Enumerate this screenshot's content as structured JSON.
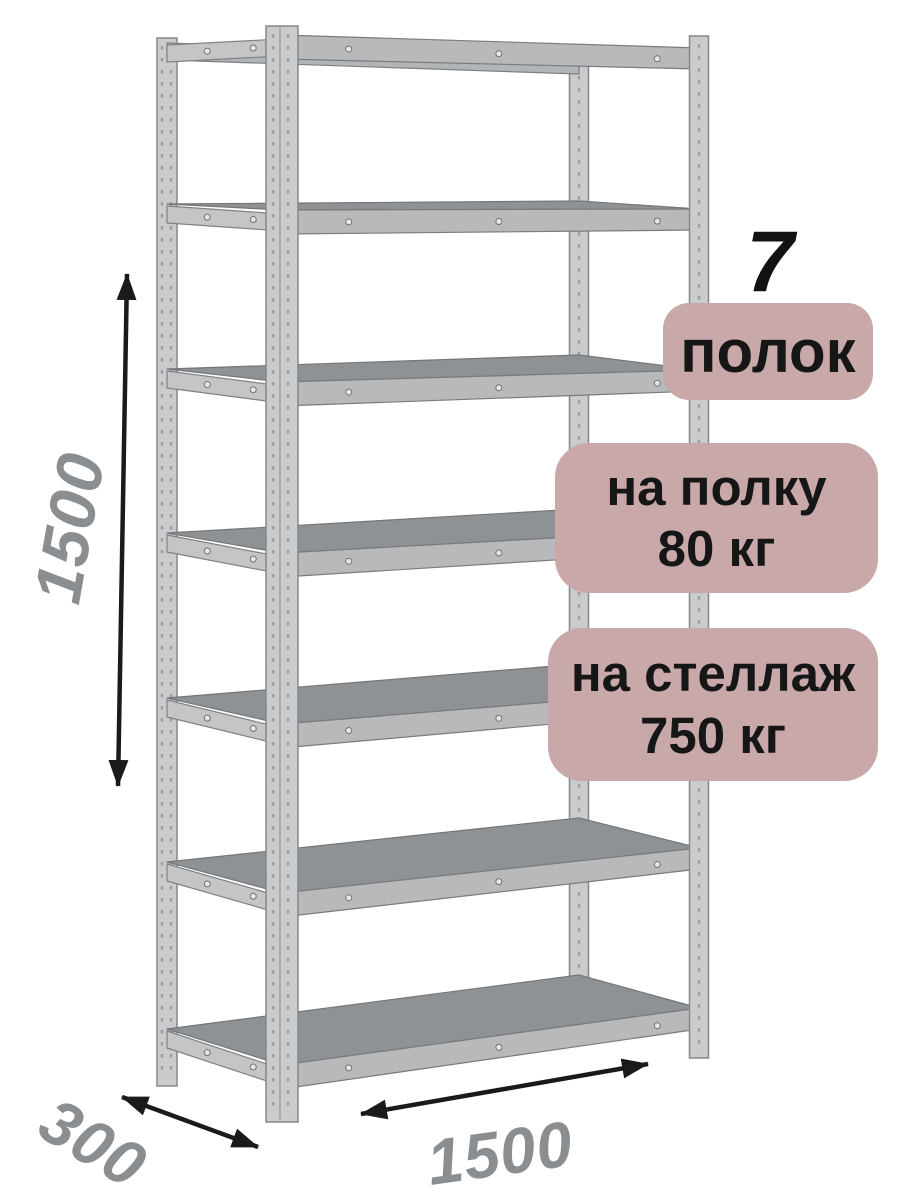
{
  "callouts": {
    "shelf_count": "7",
    "shelf_count_label": "полок",
    "per_shelf": {
      "line1": "на полку",
      "line2": "80 кг"
    },
    "per_rack": {
      "line1": "на стеллаж",
      "line2": "750 кг"
    }
  },
  "dimensions": {
    "height": "1500",
    "depth": "300",
    "width": "1500"
  },
  "structure": {
    "shelves": 7,
    "posts": 4
  },
  "colors": {
    "background": "#ffffff",
    "badge_bg": "#c9a8aa",
    "badge_text": "#161616",
    "dimension_text": "#8a8e91",
    "arrow": "#1a1a1a",
    "metal_post": "#c9cbcd",
    "metal_post_edge": "#85888b",
    "metal_rail": "#b7b9bb",
    "metal_side_rail": "#c3c5c7",
    "metal_shelf_top": "#8f9295",
    "metal_shelf_edge": "#74777a",
    "perforation": "#9b9ea1"
  }
}
